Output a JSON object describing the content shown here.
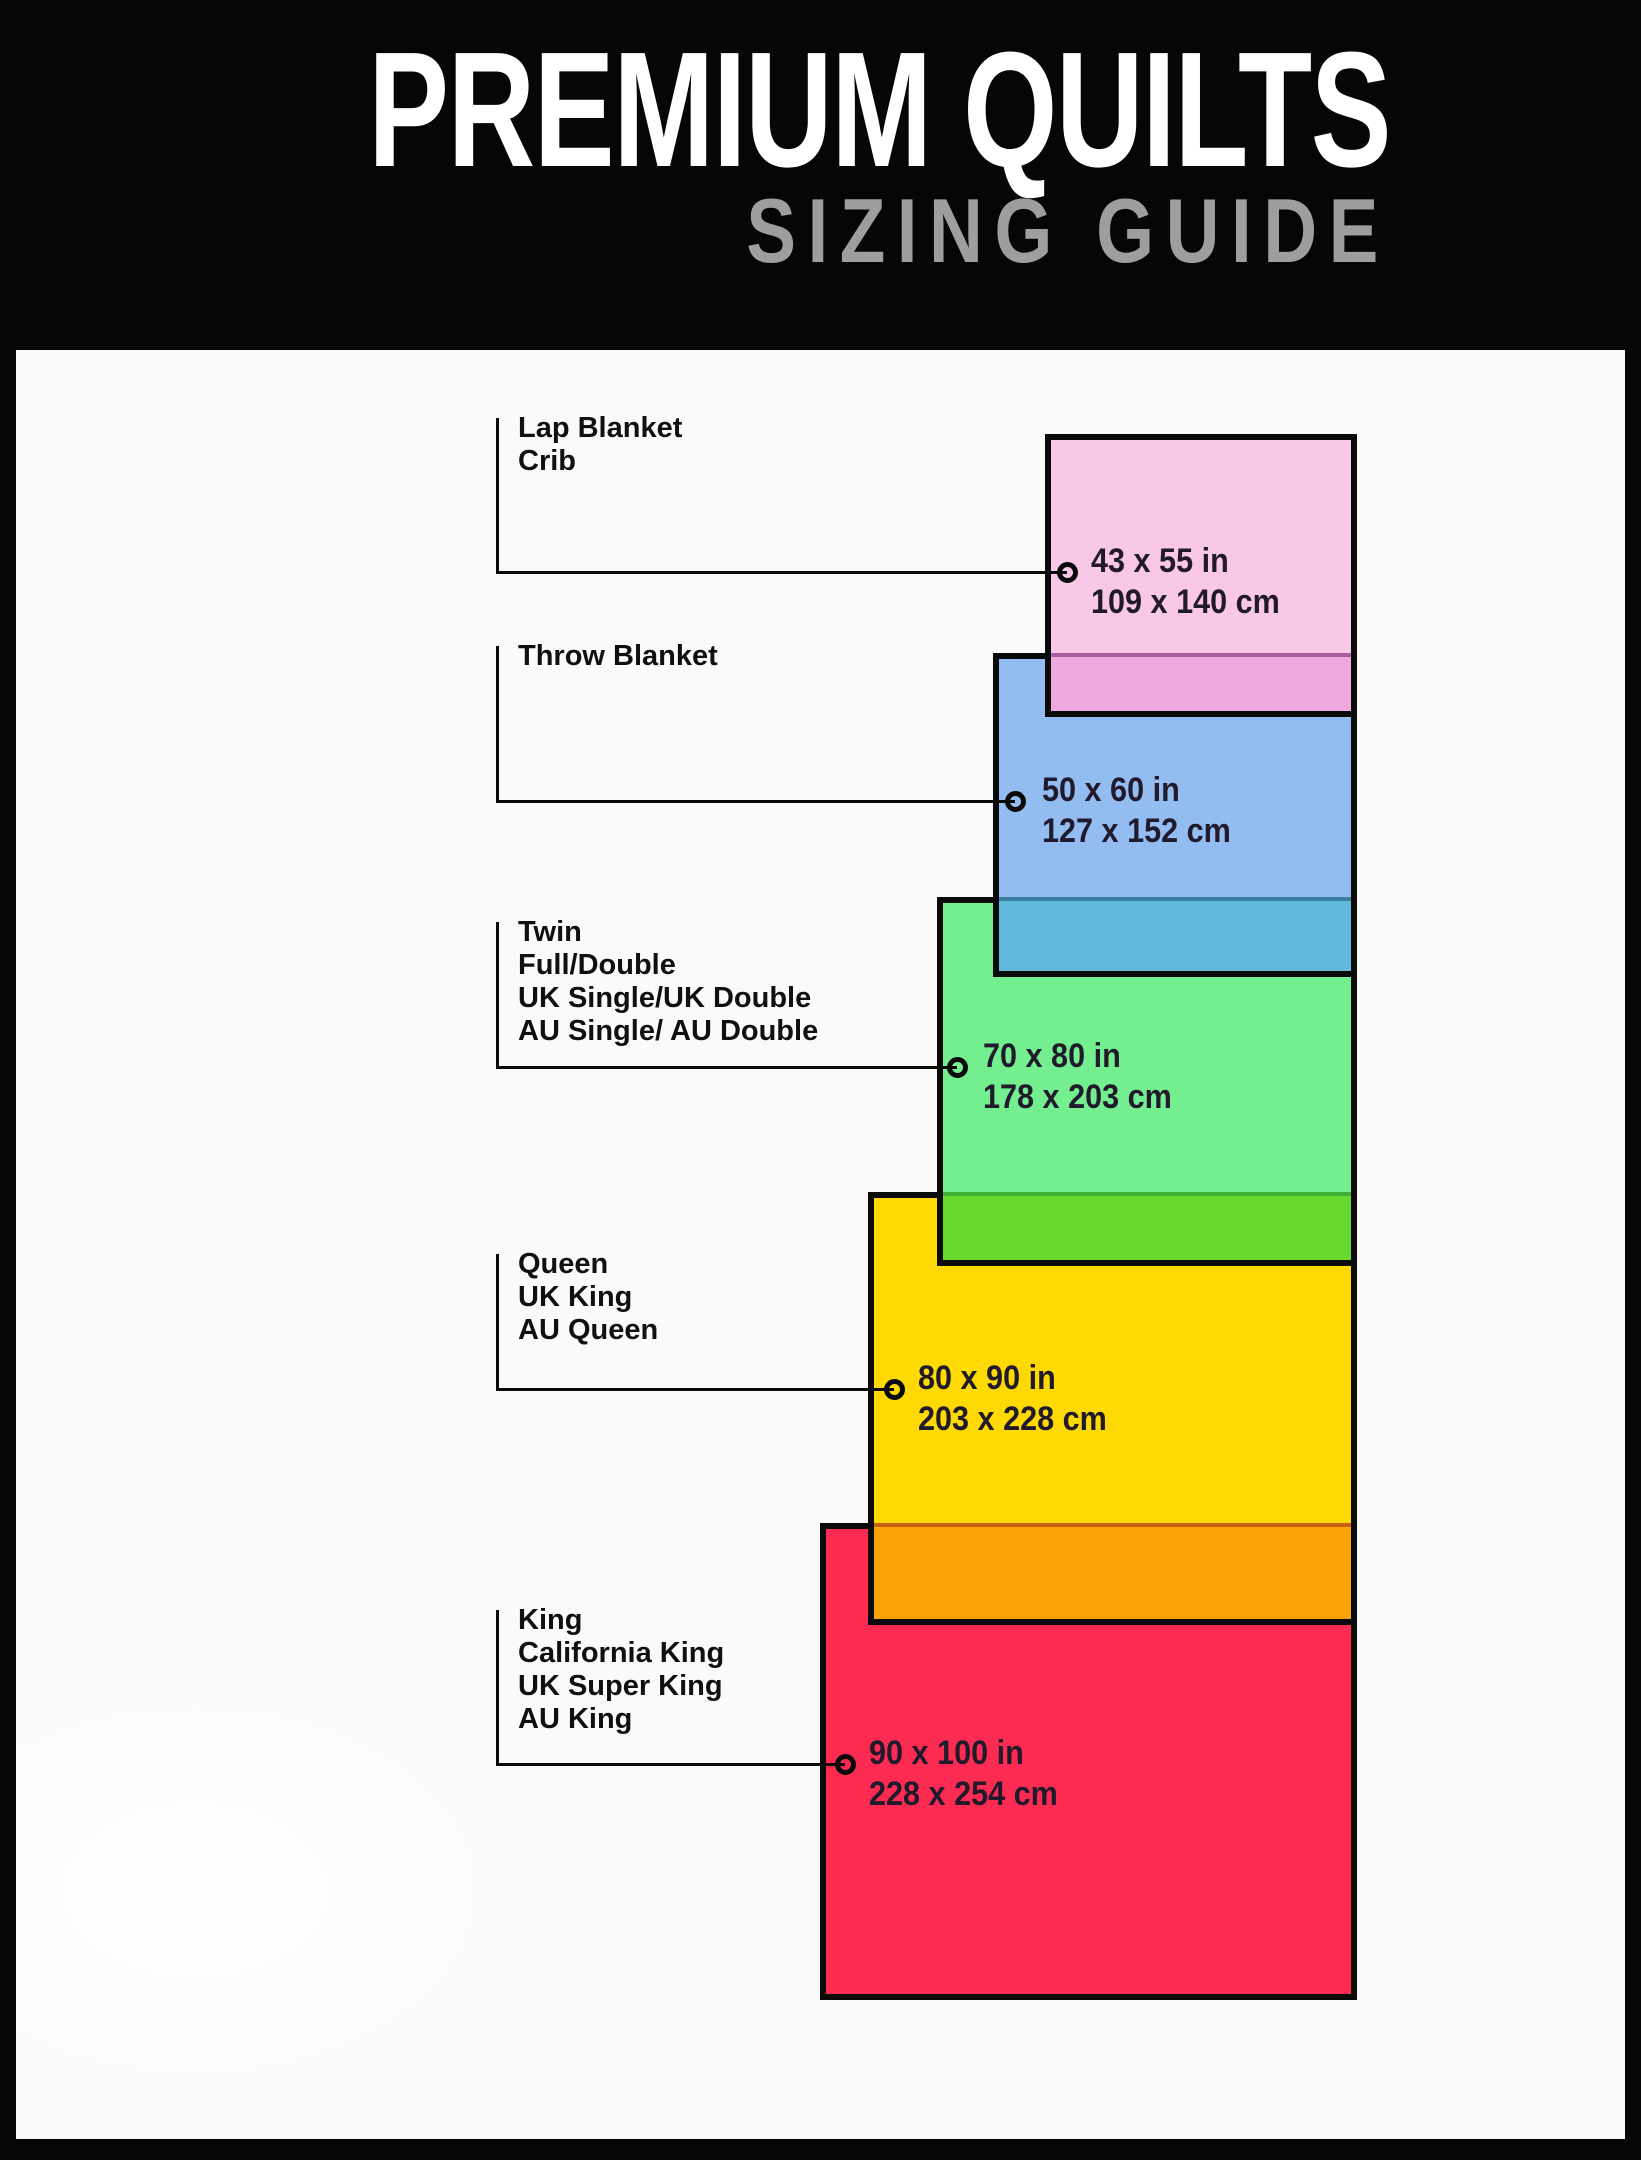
{
  "header": {
    "title": "PREMIUM QUILTS",
    "subtitle": "SIZING GUIDE",
    "title_color": "#FFFFFF",
    "subtitle_color": "#9E9E9E",
    "background": "#060606"
  },
  "canvas_background": "#FBFAF8",
  "border_color": "#0A0A0A",
  "sizes": [
    {
      "labels": [
        "Lap Blanket",
        "Crib"
      ],
      "inches": "43 x 55 in",
      "cm": "109 x 140 cm",
      "fill": "#F9C8E9",
      "overlap_fill": "#EFA9DF"
    },
    {
      "labels": [
        "Throw Blanket"
      ],
      "inches": "50 x 60 in",
      "cm": "127 x 152 cm",
      "fill": "#93BCF1",
      "overlap_fill": "#60B9DB"
    },
    {
      "labels": [
        "Twin",
        "Full/Double",
        "UK Single/UK Double",
        "AU Single/ AU Double"
      ],
      "inches": "70 x 80 in",
      "cm": "178 x 203 cm",
      "fill": "#74EF8F",
      "overlap_fill": "#68D92F"
    },
    {
      "labels": [
        "Queen",
        "UK King",
        "AU Queen"
      ],
      "inches": "80 x 90 in",
      "cm": "203 x 228 cm",
      "fill": "#FED903",
      "overlap_fill": "#F9A309"
    },
    {
      "labels": [
        "King",
        "California King",
        "UK Super King",
        "AU King"
      ],
      "inches": "90 x 100 in",
      "cm": "228 x 254 cm",
      "fill": "#FB2B52",
      "overlap_fill": null
    }
  ]
}
